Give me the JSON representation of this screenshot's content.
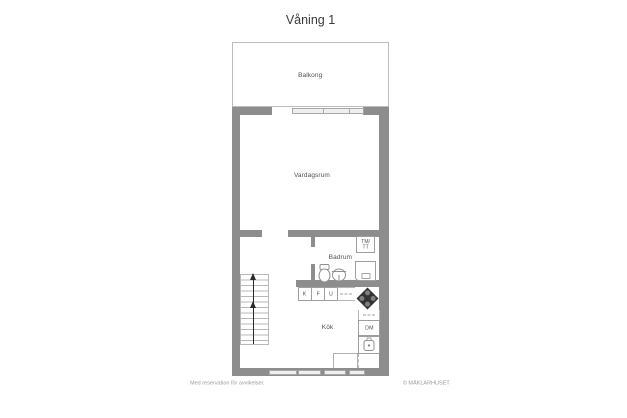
{
  "page": {
    "title": "Våning 1",
    "footer_left": "Med reservation för avvikelser.",
    "footer_right": "© MÄKLARHUSET"
  },
  "rooms": {
    "balcony": "Balkong",
    "living_room": "Vardagsrum",
    "bathroom": "Badrum",
    "kitchen": "Kök"
  },
  "appliances": {
    "washer_dryer_top": "TM/",
    "washer_dryer_bottom": "TT",
    "fridge": "K",
    "freezer": "F",
    "oven": "U",
    "dishwasher": "DM"
  },
  "colors": {
    "wall": "#8d8d8d",
    "line": "#9e9e9e",
    "window_fill": "#efefef",
    "label_text": "#4f4f4f",
    "title_text": "#3a3a3a",
    "footer_text": "#9a9a9a",
    "stove_fill": "#333333"
  }
}
